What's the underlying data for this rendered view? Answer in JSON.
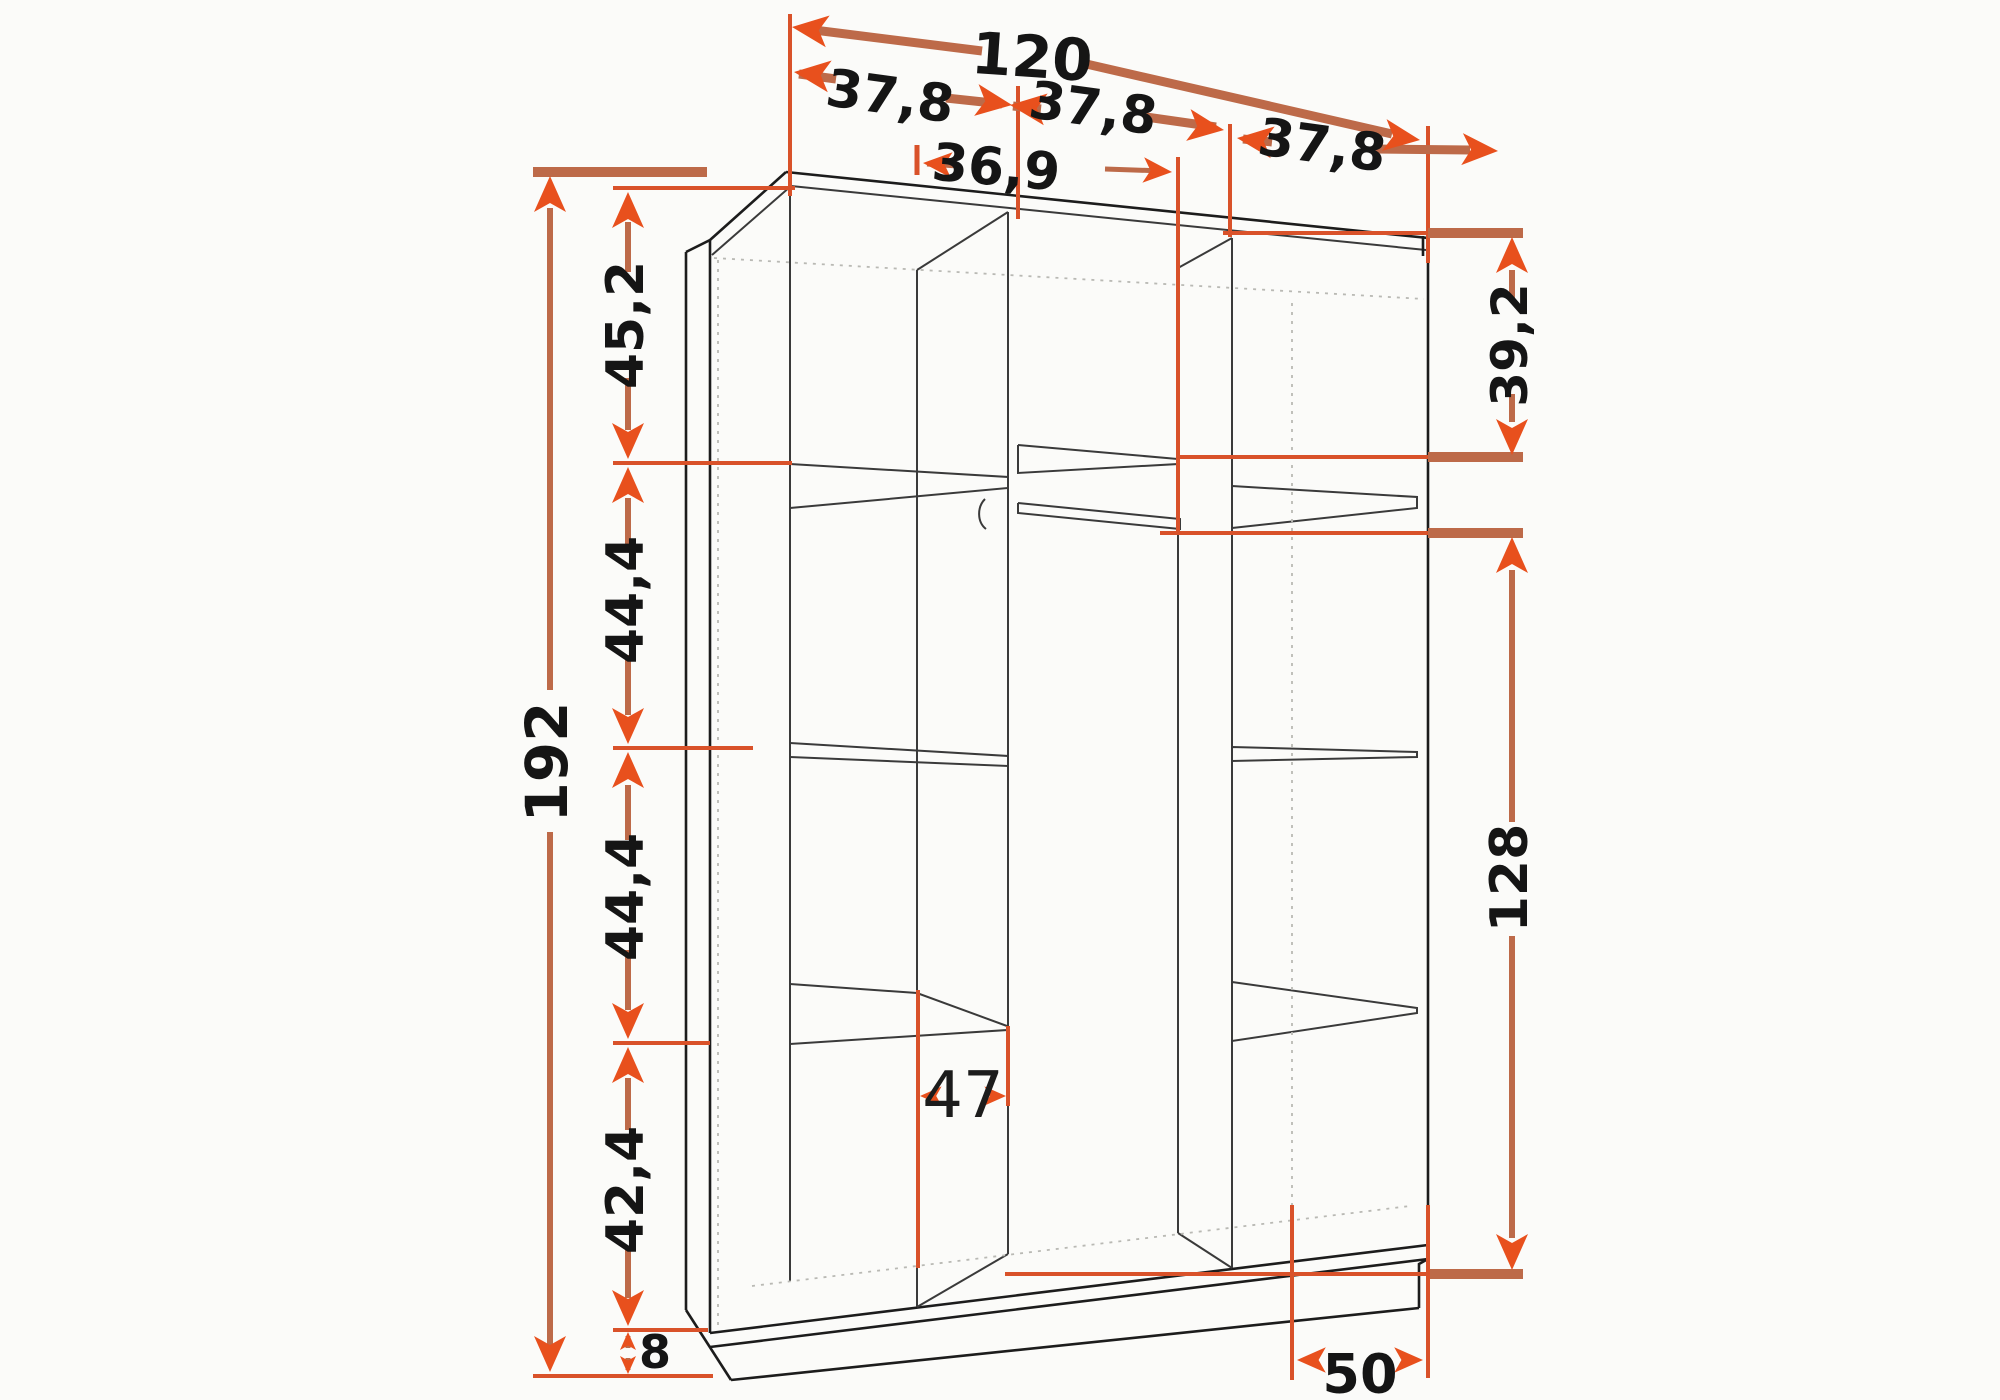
{
  "diagram": {
    "type": "furniture_dimension_drawing",
    "subject": "three-section wardrobe interior shown in perspective line drawing with orange dimension arrows",
    "units": "cm (implied)",
    "colors": {
      "outline": "#1c1c1c",
      "hidden_edge": "#b9b9b4",
      "dimension_shaft": "#bd6a49",
      "dimension_accent": "#e8501d",
      "extension_line": "#d9522a",
      "background": "#fbfbf9",
      "label_text": "#151515"
    },
    "dimensions": {
      "top": {
        "overall_width": "120",
        "section_widths": [
          "37,8",
          "37,8",
          "37,8"
        ],
        "middle_clear_width": "36,9"
      },
      "left": {
        "overall_height": "192",
        "segment_heights_top_to_bottom": [
          "45,2",
          "44,4",
          "44,4",
          "42,4",
          "8"
        ]
      },
      "right": {
        "top_compartment_height": "39,2",
        "hanging_space_height": "128"
      },
      "bottom": {
        "shelf_depth": "47",
        "base_depth": "50"
      }
    },
    "labels": {
      "overall_width": "120",
      "section_width_1": "37,8",
      "section_width_2": "37,8",
      "section_width_3": "37,8",
      "middle_clear_width": "36,9",
      "overall_height": "192",
      "seg_1": "45,2",
      "seg_2": "44,4",
      "seg_3": "44,4",
      "seg_4": "42,4",
      "plinth_height": "8",
      "right_top_height": "39,2",
      "hanging_height": "128",
      "shelf_depth": "47",
      "base_depth": "50"
    },
    "features": [
      "left section with three shelves",
      "middle section with top shelf and clothes rail",
      "right section with top shelf, middle shelf and low shelf",
      "bottom panel with plinth"
    ]
  }
}
